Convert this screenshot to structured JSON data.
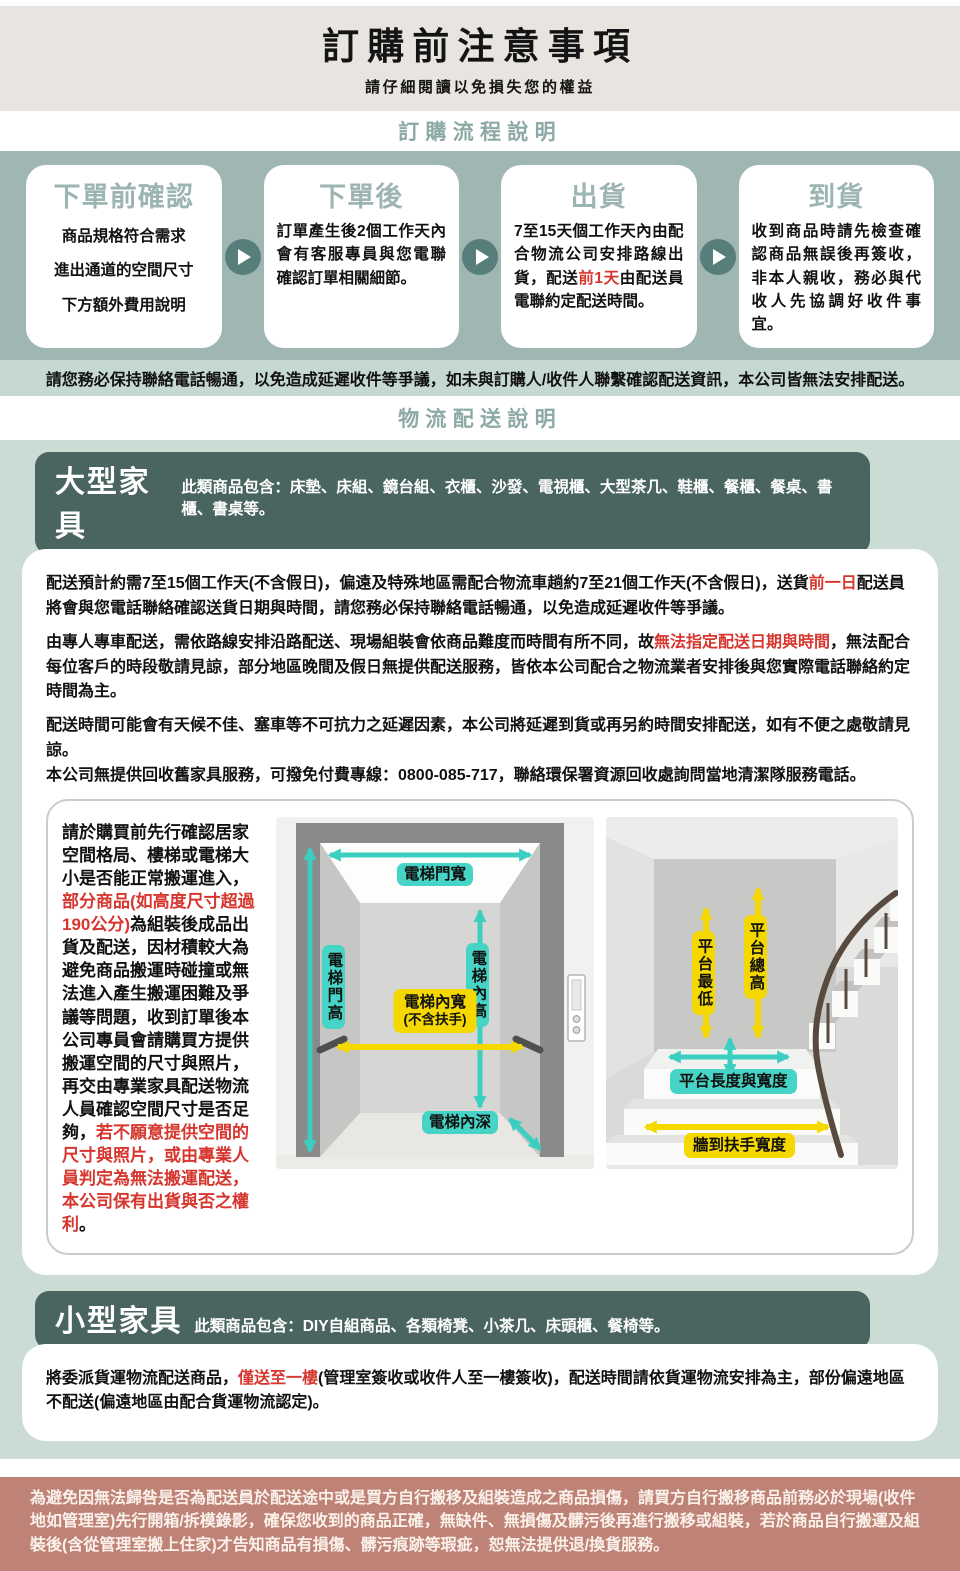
{
  "header": {
    "title": "訂購前注意事項",
    "subtitle": "請仔細閱讀以免損失您的權益"
  },
  "process": {
    "heading": "訂購流程說明",
    "steps": [
      {
        "title": "下單前確認",
        "lines": [
          [
            {
              "t": "商品規格符合需求"
            }
          ],
          [
            {
              "t": "進出通道的空間尺寸"
            }
          ],
          [
            {
              "t": "下方額外費用說明"
            }
          ]
        ]
      },
      {
        "title": "下單後",
        "lines": [
          [
            {
              "t": "訂單產生後2個工作天內會有客服專員與您電聯確認訂單相關細節。"
            }
          ]
        ]
      },
      {
        "title": "出貨",
        "lines": [
          [
            {
              "t": "7至15天個工作天內由配合物流公司安排路線出貨，配送"
            },
            {
              "t": "前1天",
              "c": "red"
            },
            {
              "t": "由配送員電聯約定配送時間。"
            }
          ]
        ]
      },
      {
        "title": "到貨",
        "lines": [
          [
            {
              "t": "收到商品時請先檢查確認商品無誤後再簽收，非本人親收，務必與代收人先協調好收件事宜。"
            }
          ]
        ]
      }
    ],
    "notice": "請您務必保持聯絡電話暢通，以免造成延遲收件等爭議，如未與訂購人/收件人聯繫確認配送資訊，本公司皆無法安排配送。"
  },
  "logistics": {
    "heading": "物流配送說明",
    "large": {
      "title": "大型家具",
      "includes": "此類商品包含：床墊、床組、鏡台組、衣櫃、沙發、電視櫃、大型茶几、鞋櫃、餐櫃、餐桌、書櫃、書桌等。",
      "paragraphs": [
        [
          [
            {
              "t": "配送預計約需7至15個工作天(不含假日)，偏遠及特殊地區需配合物流車趟約7至21個工作天(不含假日)，送貨"
            },
            {
              "t": "前一日",
              "c": "red"
            },
            {
              "t": "配送員將會與您電話聯絡確認送貨日期與時間，請您務必保持聯絡電話暢通，以免造成延遲收件等爭議。"
            }
          ]
        ],
        [
          [
            {
              "t": "由專人專車配送，需依路線安排沿路配送、現場組裝會依商品難度而時間有所不同，故"
            },
            {
              "t": "無法指定配送日期與時間",
              "c": "red"
            },
            {
              "t": "，無法配合每位客戶的時段敬請見諒，部分地區晚間及假日無提供配送服務，皆依本公司配合之物流業者安排後與您實際電話聯絡約定時間為主。"
            }
          ]
        ],
        [
          [
            {
              "t": "配送時間可能會有天候不佳、塞車等不可抗力之延遲因素，本公司將延遲到貨或再另約時間安排配送，如有不便之處敬請見諒。"
            }
          ],
          [
            {
              "t": "本公司無提供回收舊家具服務，可撥免付費專線：0800-085-717，聯絡環保署資源回收處詢問當地清潔隊服務電話。"
            }
          ]
        ]
      ],
      "side_note": [
        [
          {
            "t": "請於購買前先行確認居家空間格局、樓梯或電梯大小是否能正常搬運進入，"
          },
          {
            "t": "部分商品(如高度尺寸超過190公分)",
            "c": "red"
          },
          {
            "t": "為組裝後成品出貨及配送，因材積較大為避免商品搬運時碰撞或無法進入產生搬運困難及爭議等問題，收到訂單後本公司專員會請購買方提供搬運空間的尺寸與照片，再交由專業家具配送物流人員確認空間尺寸是否足夠，"
          },
          {
            "t": "若不願意提供空間的尺寸與照片，或由專業人員判定為無法搬運配送，本公司保有出貨與否之權利",
            "c": "red"
          },
          {
            "t": "。"
          }
        ]
      ],
      "elevator_labels": {
        "door_width": "電梯門寬",
        "door_height": "電梯門高",
        "inner_height": "電梯內高",
        "inner_width": "電梯內寬",
        "inner_width_sub": "(不含扶手)",
        "inner_depth": "電梯內深"
      },
      "stairs_labels": {
        "platform_min": "平台最低",
        "platform_total": "平台總高",
        "platform_lw": "平台長度與寬度",
        "wall_rail": "牆到扶手寬度"
      }
    },
    "small": {
      "title": "小型家具",
      "includes": "此類商品包含：DIY自組商品、各類椅凳、小茶几、床頭櫃、餐椅等。",
      "paragraph": [
        [
          {
            "t": "將委派貨運物流配送商品，"
          },
          {
            "t": "僅送至一樓",
            "c": "red"
          },
          {
            "t": "(管理室簽收或收件人至一樓簽收)，配送時間請依貨運物流安排為主，部份偏遠地區不配送(偏遠地區由配合貨運物流認定)。"
          }
        ]
      ]
    }
  },
  "footer": {
    "text": "為避免因無法歸咎是否為配送員於配送途中或是買方自行搬移及組裝造成之商品損傷，請買方自行搬移商品前務必於現場(收件地如管理室)先行開箱/拆模錄影，確保您收到的商品正確，無缺件、無損傷及髒污後再進行搬移或組裝，若於商品自行搬運及組裝後(含從管理室搬上住家)才告知商品有損傷、髒污痕跡等瑕疵，恕無法提供退/換貨服務。"
  },
  "colors": {
    "accent_teal_bg": "#9fb6b3",
    "accent_dark_teal": "#4a6560",
    "heading_teal": "#8ca9a6",
    "arrow_teal": "#3bcfc1",
    "label_yellow": "#f5d800",
    "alert_red": "#d6362e",
    "footer_salmon": "#be8276"
  }
}
